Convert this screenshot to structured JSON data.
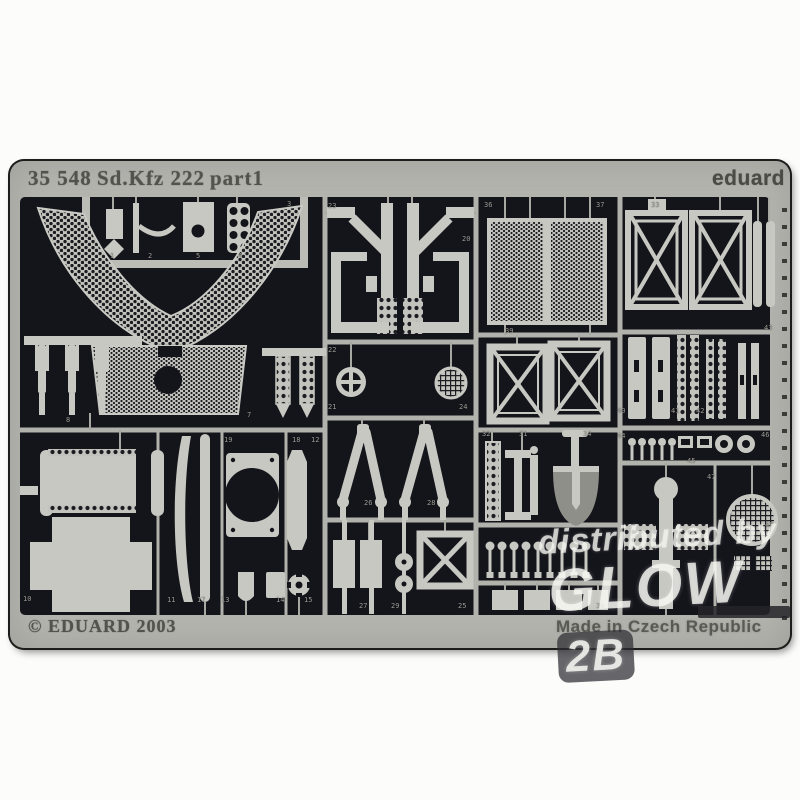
{
  "photo": {
    "header": {
      "catalog": "35 548",
      "subject": "Sd.Kfz 222",
      "part": "part1",
      "brand": "eduard"
    },
    "footer": {
      "copyright": "© EDUARD 2003",
      "made_in": "Made in Czech Republic"
    },
    "watermark": {
      "line1": "distributed by",
      "brand": "GLOW",
      "badge": "2B"
    },
    "colors": {
      "sheet_interior": "#14141b",
      "sheet_frame": "#b5b5b0",
      "etched_parts": "#c8c8c2",
      "etch_text": "#53534e"
    },
    "part_labels": [
      {
        "n": "1",
        "x": 110,
        "y": 252
      },
      {
        "n": "2",
        "x": 148,
        "y": 252
      },
      {
        "n": "5",
        "x": 196,
        "y": 252
      },
      {
        "n": "4",
        "x": 238,
        "y": 252
      },
      {
        "n": "3",
        "x": 287,
        "y": 200
      },
      {
        "n": "8",
        "x": 66,
        "y": 416
      },
      {
        "n": "7",
        "x": 247,
        "y": 411
      },
      {
        "n": "23",
        "x": 328,
        "y": 202
      },
      {
        "n": "20",
        "x": 462,
        "y": 235
      },
      {
        "n": "22",
        "x": 328,
        "y": 346
      },
      {
        "n": "21",
        "x": 328,
        "y": 403
      },
      {
        "n": "24",
        "x": 459,
        "y": 403
      },
      {
        "n": "26",
        "x": 364,
        "y": 499
      },
      {
        "n": "28",
        "x": 427,
        "y": 499
      },
      {
        "n": "27",
        "x": 359,
        "y": 602
      },
      {
        "n": "29",
        "x": 391,
        "y": 602
      },
      {
        "n": "25",
        "x": 458,
        "y": 602
      },
      {
        "n": "36",
        "x": 484,
        "y": 201
      },
      {
        "n": "37",
        "x": 596,
        "y": 201
      },
      {
        "n": "39",
        "x": 505,
        "y": 327
      },
      {
        "n": "32",
        "x": 482,
        "y": 430
      },
      {
        "n": "31",
        "x": 519,
        "y": 430
      },
      {
        "n": "34",
        "x": 583,
        "y": 430
      },
      {
        "n": "30",
        "x": 596,
        "y": 602
      },
      {
        "n": "33",
        "x": 651,
        "y": 201
      },
      {
        "n": "43",
        "x": 764,
        "y": 324
      },
      {
        "n": "40",
        "x": 617,
        "y": 407
      },
      {
        "n": "41",
        "x": 671,
        "y": 407
      },
      {
        "n": "42",
        "x": 696,
        "y": 407
      },
      {
        "n": "44",
        "x": 617,
        "y": 432
      },
      {
        "n": "45",
        "x": 687,
        "y": 457
      },
      {
        "n": "46",
        "x": 761,
        "y": 431
      },
      {
        "n": "47",
        "x": 707,
        "y": 473
      },
      {
        "n": "48",
        "x": 765,
        "y": 521
      },
      {
        "n": "10",
        "x": 23,
        "y": 595
      },
      {
        "n": "11",
        "x": 167,
        "y": 596
      },
      {
        "n": "17",
        "x": 197,
        "y": 596
      },
      {
        "n": "13",
        "x": 221,
        "y": 596
      },
      {
        "n": "14",
        "x": 276,
        "y": 596
      },
      {
        "n": "15",
        "x": 304,
        "y": 596
      },
      {
        "n": "19",
        "x": 224,
        "y": 436
      },
      {
        "n": "18",
        "x": 292,
        "y": 436
      },
      {
        "n": "12",
        "x": 311,
        "y": 436
      }
    ]
  }
}
